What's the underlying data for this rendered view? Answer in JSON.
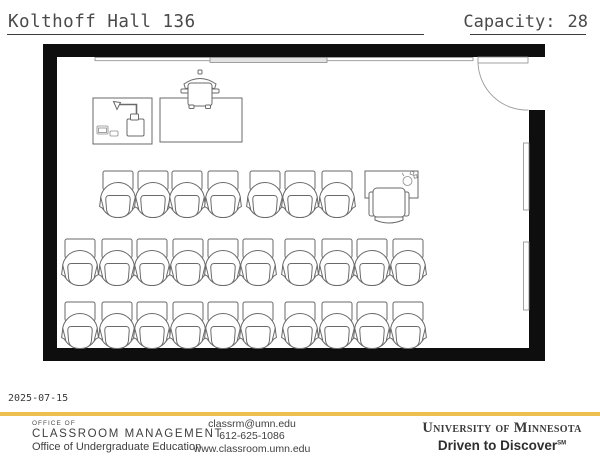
{
  "header": {
    "room_title": "Kolthoff Hall 136",
    "capacity_label": "Capacity:",
    "capacity_value": "28"
  },
  "plan": {
    "capacity": 28,
    "wall_color": "#0e0e0e",
    "line_color": "#6a6a6a",
    "chair_rows": [
      {
        "y": 171,
        "xs": [
          103,
          138,
          172,
          208,
          250,
          285,
          322
        ]
      },
      {
        "y": 239,
        "xs": [
          65,
          102,
          137,
          173,
          208,
          243,
          285,
          322,
          357,
          393
        ]
      },
      {
        "y": 302,
        "xs": [
          65,
          102,
          137,
          173,
          208,
          243,
          285,
          322,
          357,
          393
        ]
      }
    ],
    "features": {
      "demo_table": "equipment table with document camera and monitor",
      "demo_chair": "task chair behind demo table",
      "instructor_station": "instructor table with chair and AV equipment",
      "door": "door at top-right, swings inward",
      "boards": "wall-mounted boards on top and right walls"
    }
  },
  "footer": {
    "date": "2025-07-15",
    "accent_color": "#edbf50",
    "office_small": "OFFICE OF",
    "office_name": "CLASSROOM MANAGEMENT",
    "office_sub": "Office of Undergraduate Education",
    "contact_email": "classrm@umn.edu",
    "contact_phone": "612-625-1086",
    "contact_web": "www.classroom.umn.edu",
    "brand_university": "University of Minnesota",
    "brand_tagline": "Driven to Discover",
    "brand_tagline_mark": "SM"
  }
}
